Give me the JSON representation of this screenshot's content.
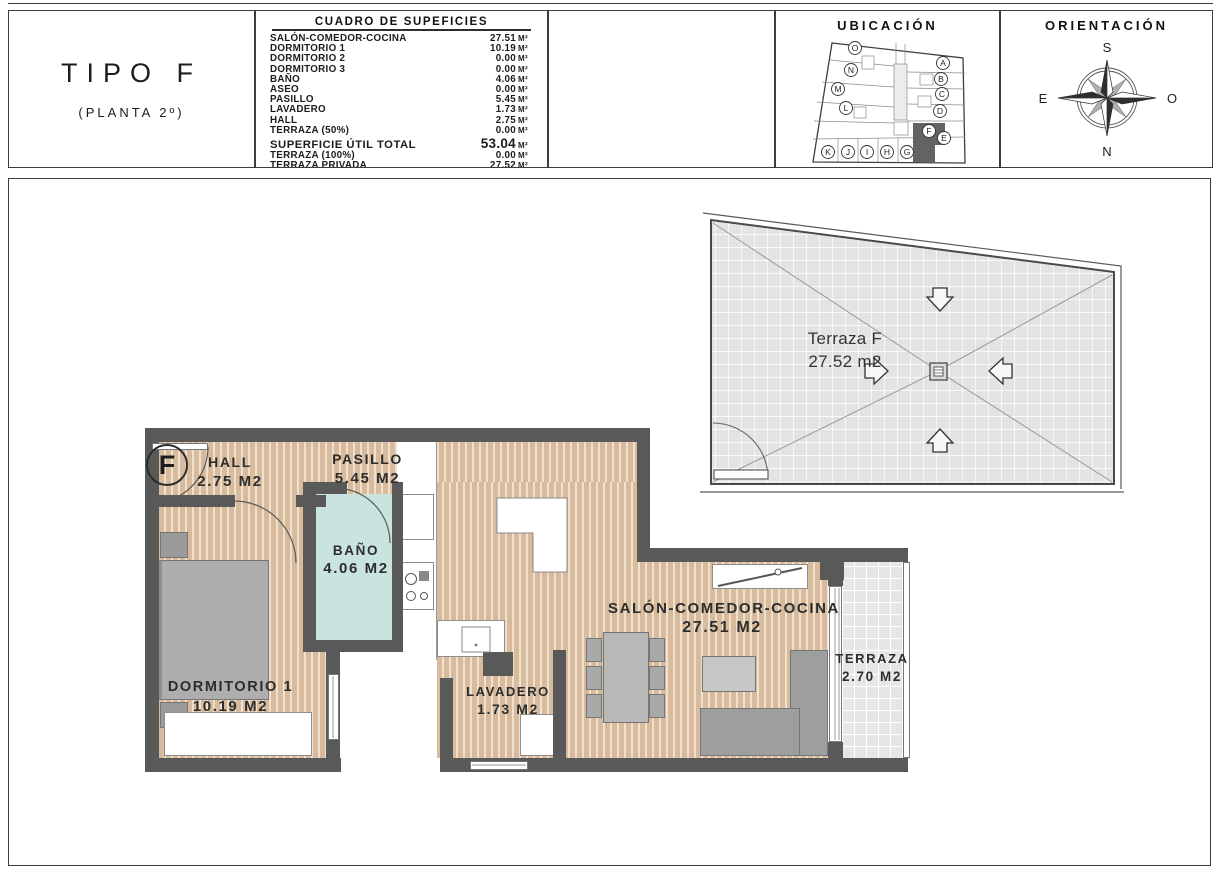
{
  "header": {
    "type_box": {
      "title": "TIPO F",
      "subtitle": "(PLANTA 2º)"
    },
    "surfaces": {
      "title": "CUADRO DE SUPEFICIES",
      "unit": "M²",
      "rows": [
        {
          "label": "SALÓN-COMEDOR-COCINA",
          "value": "27.51"
        },
        {
          "label": "DORMITORIO 1",
          "value": "10.19"
        },
        {
          "label": "DORMITORIO 2",
          "value": "0.00"
        },
        {
          "label": "DORMITORIO 3",
          "value": "0.00"
        },
        {
          "label": "BAÑO",
          "value": "4.06"
        },
        {
          "label": "ASEO",
          "value": "0.00"
        },
        {
          "label": "PASILLO",
          "value": "5.45"
        },
        {
          "label": "LAVADERO",
          "value": "1.73"
        },
        {
          "label": "HALL",
          "value": "2.75"
        },
        {
          "label": "TERRAZA (50%)",
          "value": "0.00"
        }
      ],
      "total": {
        "label": "SUPERFICIE ÚTIL TOTAL",
        "value": "53.04"
      },
      "extra": [
        {
          "label": "TERRAZA (100%)",
          "value": "0.00"
        },
        {
          "label": "TERRAZA PRIVADA",
          "value": "27.52"
        }
      ]
    },
    "ubicacion": {
      "title": "UBICACIÓN",
      "highlighted_unit": "F",
      "letters": [
        "O",
        "N",
        "M",
        "L",
        "A",
        "B",
        "C",
        "D",
        "E",
        "F",
        "K",
        "J",
        "I",
        "H",
        "G"
      ]
    },
    "orientacion": {
      "title": "ORIENTACIÓN",
      "top": "S",
      "bottom": "N",
      "left": "E",
      "right": "O"
    }
  },
  "plan": {
    "unit_badge": "F",
    "rooms": [
      {
        "name": "HALL",
        "area": "2.75 M2"
      },
      {
        "name": "PASILLO",
        "area": "5.45 M2"
      },
      {
        "name": "BAÑO",
        "area": "4.06 M2"
      },
      {
        "name": "DORMITORIO 1",
        "area": "10.19 M2"
      },
      {
        "name": "LAVADERO",
        "area": "1.73 M2"
      },
      {
        "name": "SALÓN-COMEDOR-COCINA",
        "area": "27.51 M2"
      },
      {
        "name": "TERRAZA",
        "area": "2.70 M2"
      }
    ],
    "roof_terrace": {
      "name": "Terraza F",
      "area": "27.52 m2"
    }
  },
  "colors": {
    "wall": "#595959",
    "wood": "#d7bb9c",
    "bath": "#c9e3df",
    "tile": "#e6e6e6"
  }
}
